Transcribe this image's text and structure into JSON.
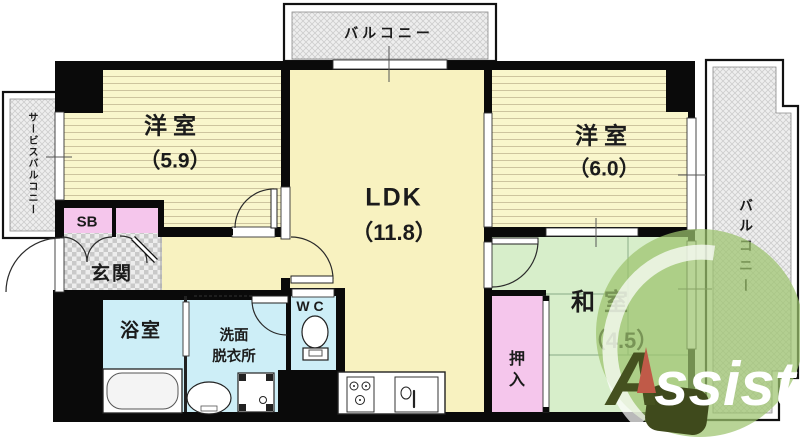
{
  "colors": {
    "wall": "#0a0a0a",
    "ldk_yellow": "#f8f2c0",
    "striped_room_yellow": "#f9f6cc",
    "tatami_green": "#d7eeca",
    "wet_area_cyan": "#cdeef7",
    "closet_pink": "#f5c6ec",
    "balcony_gray": "#ececec",
    "logo_green": "#9cc36d",
    "logo_dark_olive": "#45511f",
    "logo_red": "#c05a48"
  },
  "rooms": {
    "west1": {
      "label": "洋室",
      "size": "（5.9）"
    },
    "ldk": {
      "label": "LDK",
      "size": "（11.8）"
    },
    "west2": {
      "label": "洋室",
      "size": "（6.0）"
    },
    "japanese": {
      "label": "和室",
      "size": "（4.5）"
    },
    "entrance": {
      "label": "玄関"
    },
    "bathroom": {
      "label": "浴室"
    },
    "washroom": {
      "label1": "洗面",
      "label2": "脱衣所"
    },
    "toilet": {
      "label": "WC"
    },
    "closet": {
      "label": "押入"
    },
    "shoe_box": {
      "label": "SB"
    },
    "balcony_top": {
      "label": "バルコニー"
    },
    "balcony_right": {
      "label": "バルコニー"
    },
    "service_balcony": {
      "label": "サービスバルコニー"
    }
  },
  "logo": {
    "a": "A",
    "rest": "ssist"
  }
}
